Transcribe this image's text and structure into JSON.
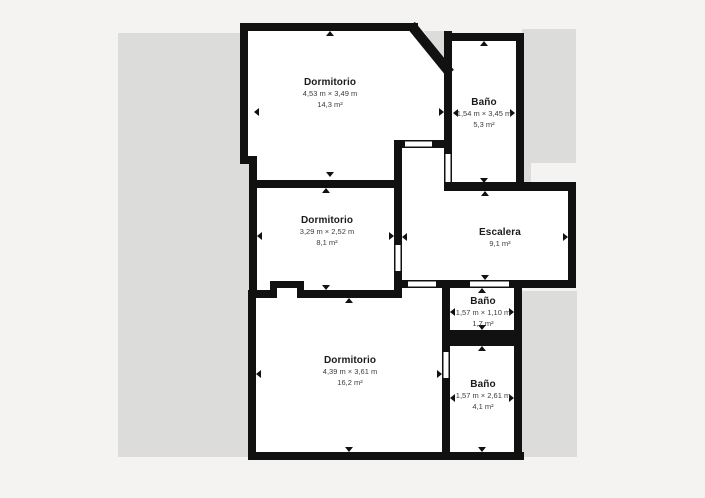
{
  "plan": {
    "title": "Floor plan",
    "rooms": [
      {
        "name": "Dormitorio",
        "dimensions": "4,53 m × 3,49 m",
        "area": "14,3 m²"
      },
      {
        "name": "Baño",
        "dimensions": "1,54 m × 3,45 m",
        "area": "5,3 m²"
      },
      {
        "name": "Dormitorio",
        "dimensions": "3,29 m × 2,52 m",
        "area": "8,1 m²"
      },
      {
        "name": "Escalera",
        "area": "9,1 m²"
      },
      {
        "name": "Baño",
        "dimensions": "1,57 m × 1,10 m",
        "area": "1,7 m²"
      },
      {
        "name": "Dormitorio",
        "dimensions": "4,39 m × 3,61 m",
        "area": "16,2 m²"
      },
      {
        "name": "Baño",
        "dimensions": "1,57 m × 2,61 m",
        "area": "4,1 m²"
      }
    ],
    "colors": {
      "wall": "#111111",
      "room_fill": "#ffffff",
      "adjacent_area": "#dcdcda",
      "background": "#f4f3f1"
    }
  }
}
